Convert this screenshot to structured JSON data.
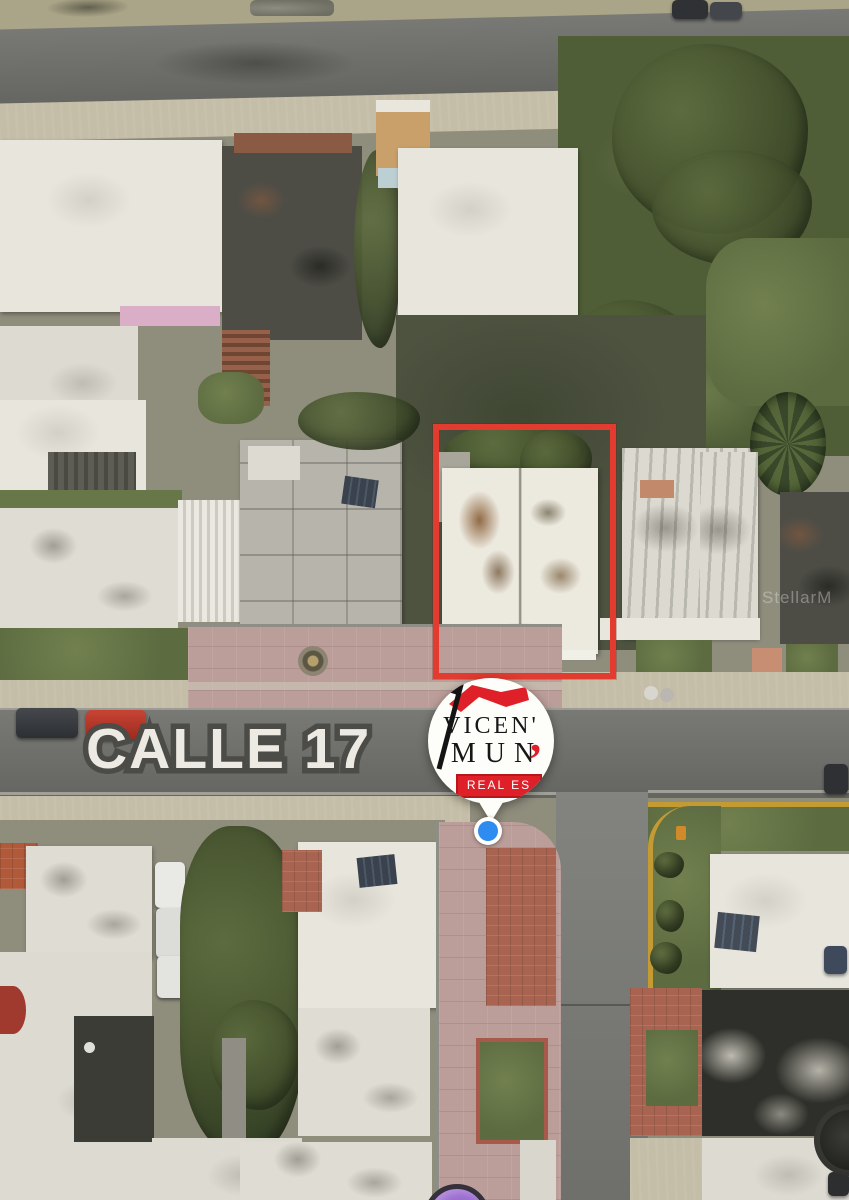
{
  "map": {
    "street_label": "CALLE 17",
    "watermark": "StellarM",
    "highlight_box_color": "#e23b30",
    "location_dot_color": "#2e8bf0",
    "secondary_marker_color": "#9b6cd0"
  },
  "logo": {
    "name_line1": "VICEN'",
    "name_line2": "MUN",
    "comma": "’",
    "banner_label": "REAL ES",
    "accent_color": "#df2028"
  }
}
